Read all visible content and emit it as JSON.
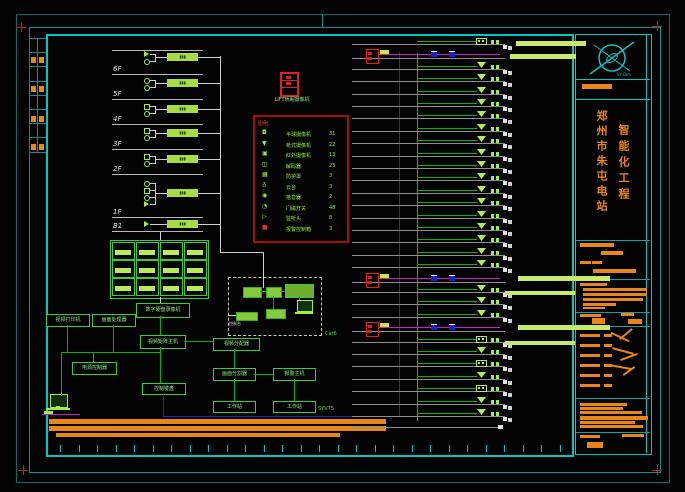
{
  "colors": {
    "frame_outer": "#0b6b6b",
    "frame_inner": "#0e8f8f",
    "main_border": "#00c6c6",
    "row_gray": "#8f8f8f",
    "green_line": "#00b400",
    "lt_green": "#b9e85a",
    "box_green": "#35cf35",
    "text_green": "#9ded46",
    "white": "#e9e9e9",
    "red": "#d92222",
    "magenta": "#c520c5",
    "blue": "#2020d8",
    "orange": "#e8861a",
    "teal_text": "#19bdbd"
  },
  "riser": {
    "roof_y": 50,
    "floors": [
      {
        "label": "6F",
        "y": 74
      },
      {
        "label": "5F",
        "y": 99
      },
      {
        "label": "4F",
        "y": 124
      },
      {
        "label": "3F",
        "y": 149
      },
      {
        "label": "2F",
        "y": 174
      },
      {
        "label": "1F",
        "y": 217
      },
      {
        "label": "B1",
        "y": 231
      }
    ],
    "groups": [
      {
        "y": 57,
        "syms": [
          "tri",
          "dot"
        ]
      },
      {
        "y": 83,
        "syms": [
          "dot",
          "dot"
        ]
      },
      {
        "y": 109,
        "syms": [
          "sq",
          "dot"
        ]
      },
      {
        "y": 133,
        "syms": [
          "sq",
          "dot"
        ]
      },
      {
        "y": 159,
        "syms": [
          "sq",
          "dot"
        ]
      },
      {
        "y": 193,
        "syms": [
          "dot",
          "sq",
          "dot",
          "tri"
        ]
      },
      {
        "y": 224,
        "syms": [
          "tri"
        ]
      }
    ]
  },
  "elevator": {
    "label": "LIFT轿厢摄像机"
  },
  "legend": {
    "title": "图例:",
    "rows": [
      {
        "sym": "◘",
        "name": "半球摄像机",
        "qty": "31"
      },
      {
        "sym": "▼",
        "name": "枪式摄像机",
        "qty": "22"
      },
      {
        "sym": "▣",
        "name": "红外摄像机",
        "qty": "13"
      },
      {
        "sym": "◫",
        "name": "解码器",
        "qty": "23"
      },
      {
        "sym": "▦",
        "name": "防护罩",
        "qty": "3"
      },
      {
        "sym": "♁",
        "name": "云台",
        "qty": "3"
      },
      {
        "sym": "◉",
        "name": "拾音器",
        "qty": "2"
      },
      {
        "sym": "◔",
        "name": "门磁开关",
        "qty": "48"
      },
      {
        "sym": "▷",
        "name": "监听头",
        "qty": "8"
      },
      {
        "sym": "■",
        "name": "报警控制箱",
        "qty": "3",
        "red": true
      }
    ]
  },
  "head_end": {
    "dvr": "数字硬盘录像机",
    "matrix": "视频矩阵主机",
    "printer": "视频打印机",
    "processor": "画面处理器",
    "splitter": "视频分配器",
    "keyboard": "控制键盘",
    "power": "电源控制器",
    "quad": "画面分割器",
    "alarm": "报警主机",
    "ws1": "工作站",
    "ws2": "工作站",
    "console_label": "控制台"
  },
  "cables": {
    "cat6": "Cat6",
    "coax": "SYV75"
  },
  "rows": [
    {
      "sym": "cd",
      "bar": [
        516,
        -3,
        70,
        5
      ]
    },
    {
      "trunk": true,
      "bar": [
        510,
        -2,
        66,
        5
      ]
    },
    {
      "sym": "dome"
    },
    {
      "sym": "dome"
    },
    {
      "sym": "dome"
    },
    {
      "sym": "dome"
    },
    {
      "sym": "dome"
    },
    {
      "sym": "dome"
    },
    {
      "sym": "dome"
    },
    {
      "sym": "dome"
    },
    {
      "sym": "dome"
    },
    {
      "sym": "dome"
    },
    {
      "sym": "dome"
    },
    {
      "sym": "dome"
    },
    {
      "sym": "dome"
    },
    {
      "sym": "dome"
    },
    {
      "sym": "dome"
    },
    {
      "sym": "dome"
    },
    {
      "sym": "dome"
    },
    {
      "trunk": true,
      "bar": [
        518,
        -4,
        92,
        5
      ]
    },
    {
      "sym": "dome",
      "bar": [
        505,
        -1,
        70,
        4
      ]
    },
    {
      "sym": "dome"
    },
    {
      "sym": "dome"
    },
    {
      "trunk": true,
      "bar": [
        518,
        -4,
        92,
        5
      ]
    },
    {
      "sym": "cd",
      "bar": [
        505,
        -1,
        70,
        4
      ]
    },
    {
      "sym": "dome"
    },
    {
      "sym": "cd"
    },
    {
      "sym": "dome"
    },
    {
      "sym": "cd"
    },
    {
      "sym": "dome"
    },
    {
      "sym": "dome"
    }
  ],
  "title_block": {
    "logo_text": "SY-Dim",
    "project_col1": "郑州市朱屯电站",
    "project_col2": "智能化工程",
    "strip_pair_ys": [
      57,
      86,
      116,
      144
    ],
    "bars": [
      [
        580,
        243,
        34,
        4
      ],
      [
        601,
        251,
        22,
        4
      ],
      [
        580,
        261,
        11,
        3
      ],
      [
        592,
        261,
        10,
        3
      ],
      [
        593,
        269,
        43,
        4
      ],
      [
        580,
        283,
        27,
        3
      ],
      [
        583,
        288,
        64,
        3
      ],
      [
        583,
        293,
        64,
        3
      ],
      [
        583,
        298,
        60,
        3
      ],
      [
        583,
        303,
        33,
        3
      ],
      [
        583,
        307,
        22,
        2
      ],
      [
        580,
        314,
        21,
        3
      ],
      [
        621,
        313,
        13,
        3
      ],
      [
        592,
        318,
        13,
        6
      ],
      [
        628,
        319,
        14,
        5
      ],
      [
        580,
        334,
        20,
        3
      ],
      [
        604,
        334,
        8,
        3
      ],
      [
        580,
        344,
        20,
        3
      ],
      [
        604,
        344,
        8,
        3
      ],
      [
        580,
        354,
        20,
        3
      ],
      [
        604,
        354,
        8,
        3
      ],
      [
        580,
        364,
        20,
        3
      ],
      [
        604,
        364,
        8,
        3
      ],
      [
        580,
        374,
        20,
        3
      ],
      [
        604,
        374,
        8,
        3
      ],
      [
        580,
        384,
        20,
        3
      ],
      [
        604,
        384,
        8,
        3
      ],
      [
        580,
        403,
        47,
        3
      ],
      [
        580,
        407,
        43,
        3
      ],
      [
        580,
        411,
        62,
        3
      ],
      [
        580,
        416,
        68,
        4
      ],
      [
        580,
        421,
        55,
        3
      ],
      [
        580,
        425,
        63,
        3
      ],
      [
        580,
        435,
        20,
        3
      ],
      [
        622,
        434,
        22,
        3
      ],
      [
        587,
        442,
        16,
        6
      ],
      [
        582,
        84,
        30,
        5
      ]
    ],
    "sig_strokes": [
      [
        610,
        336,
        20,
        25
      ],
      [
        618,
        333,
        16,
        -40
      ],
      [
        612,
        350,
        22,
        15
      ],
      [
        620,
        356,
        18,
        -20
      ],
      [
        608,
        366,
        24,
        10
      ],
      [
        622,
        370,
        14,
        -35
      ]
    ]
  }
}
